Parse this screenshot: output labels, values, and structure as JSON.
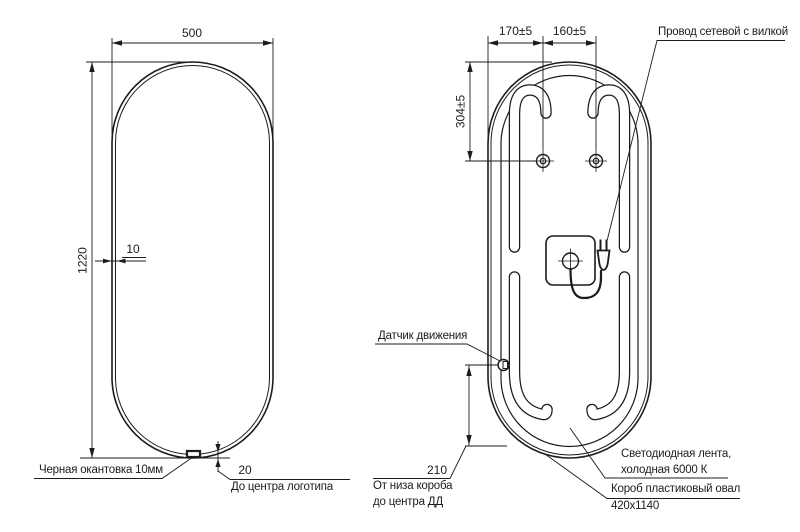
{
  "front_view": {
    "width": "500",
    "height": "1220",
    "edging_thickness": "10",
    "logo_offset": "20",
    "edging_label": "Черная окантовка 10мм",
    "logo_label": "До центра логотипа"
  },
  "back_view": {
    "hole_offset": "170±5",
    "hole_spacing": "160±5",
    "hole_from_top": "304±5",
    "cord_label": "Провод сетевой с вилкой",
    "sensor_label": "Датчик движения",
    "sensor_offset": "210",
    "sensor_note_line1": "От низа короба",
    "sensor_note_line2": "до центра ДД",
    "led_label_line1": "Светодиодная лента,",
    "led_label_line2": "холодная 6000 К",
    "box_label": "Короб пластиковый овал",
    "box_size": "420х1140"
  },
  "colors": {
    "line": "#1c1c1c",
    "background": "#ffffff"
  }
}
